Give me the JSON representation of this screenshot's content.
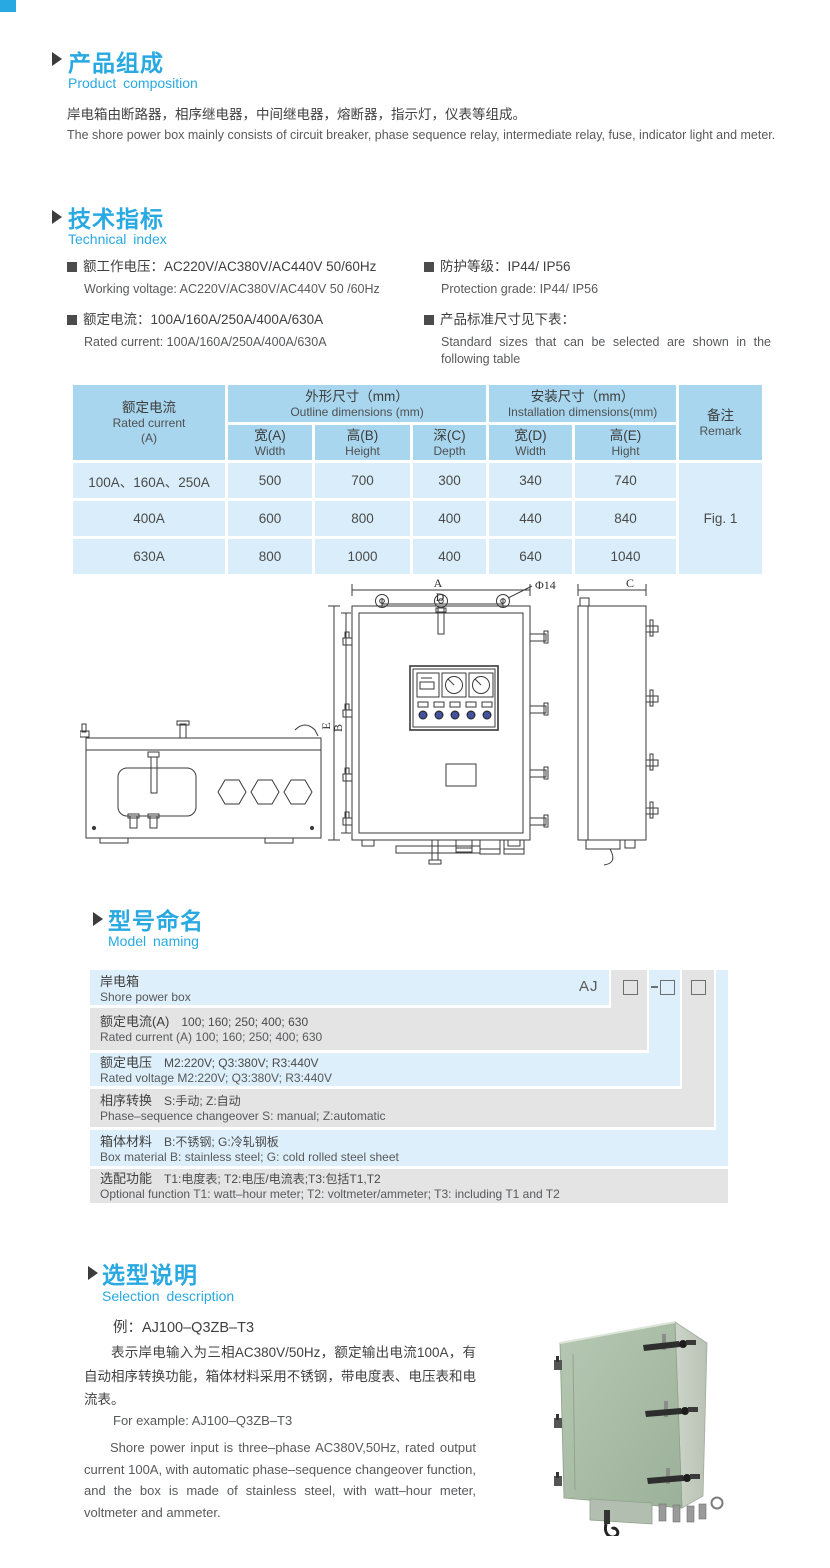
{
  "colors": {
    "accent": "#29a9e1",
    "table_header_bg": "#a8d6ee",
    "table_body_bg": "#d9eefa",
    "ladder_blue": "#ddeffa",
    "ladder_gray": "#e4e4e4",
    "text_dark": "#3f3f3f",
    "text_gray": "#58595b",
    "product_green": "#a9bda6"
  },
  "product_composition": {
    "title_cn": "产品组成",
    "title_en": "Product composition",
    "body_cn": "岸电箱由断路器，相序继电器，中间继电器，熔断器，指示灯，仪表等组成。",
    "body_en": "The shore power box mainly consists of circuit breaker, phase sequence relay, intermediate relay, fuse, indicator light and meter."
  },
  "technical_index": {
    "title_cn": "技术指标",
    "title_en": "Technical index",
    "specs_left": [
      {
        "cn": "额工作电压：AC220V/AC380V/AC440V  50/60Hz",
        "en": "Working voltage: AC220V/AC380V/AC440V 50 /60Hz"
      },
      {
        "cn": "额定电流：100A/160A/250A/400A/630A",
        "en": "Rated current: 100A/160A/250A/400A/630A"
      }
    ],
    "specs_right": [
      {
        "cn": "防护等级：IP44/ IP56",
        "en": "Protection grade: IP44/ IP56"
      },
      {
        "cn": "产品标准尺寸见下表：",
        "en": "Standard sizes that can be selected are shown in the following table"
      }
    ]
  },
  "dimensions_table": {
    "rated_current_header": {
      "cn": "额定电流",
      "en": "Rated current",
      "unit": "(A)"
    },
    "outline_group": {
      "cn": "外形尺寸（mm）",
      "en": "Outline dimensions (mm)"
    },
    "install_group": {
      "cn": "安装尺寸（mm）",
      "en": "Installation dimensions(mm)"
    },
    "remark_header": {
      "cn": "备注",
      "en": "Remark"
    },
    "sub_headers": [
      {
        "cn": "宽(A)",
        "en": "Width"
      },
      {
        "cn": "高(B)",
        "en": "Height"
      },
      {
        "cn": "深(C)",
        "en": "Depth"
      },
      {
        "cn": "宽(D)",
        "en": "Width"
      },
      {
        "cn": "高(E)",
        "en": "Hight"
      }
    ],
    "rows": [
      {
        "current": "100A、160A、250A",
        "w": "500",
        "h": "700",
        "d": "300",
        "iw": "340",
        "ih": "740"
      },
      {
        "current": "400A",
        "w": "600",
        "h": "800",
        "d": "400",
        "iw": "440",
        "ih": "840"
      },
      {
        "current": "630A",
        "w": "800",
        "h": "1000",
        "d": "400",
        "iw": "640",
        "ih": "1040"
      }
    ],
    "remark_value": "Fig. 1"
  },
  "drawing": {
    "dim_a": "A",
    "dim_d": "D",
    "dim_phi": "Φ14",
    "dim_e": "E",
    "dim_b": "B",
    "dim_c": "C"
  },
  "model_naming": {
    "title_cn": "型号命名",
    "title_en": "Model naming",
    "code_prefix": "AJ",
    "rows": [
      {
        "label_cn": "岸电箱",
        "value_cn": "",
        "label_en": "Shore power box",
        "value_en": ""
      },
      {
        "label_cn": "额定电流(A)",
        "value_cn": "100; 160; 250; 400; 630",
        "label_en": "Rated current (A)",
        "value_en": "100; 160; 250; 400; 630"
      },
      {
        "label_cn": "额定电压",
        "value_cn": "M2:220V;  Q3:380V;  R3:440V",
        "label_en": "Rated voltage",
        "value_en": "M2:220V;  Q3:380V;  R3:440V"
      },
      {
        "label_cn": "相序转换",
        "value_cn": "S:手动; Z:自动",
        "label_en": "Phase–sequence changeover",
        "value_en": "S: manual;  Z:automatic"
      },
      {
        "label_cn": "箱体材料",
        "value_cn": "B:不锈钢;  G:冷轧钢板",
        "label_en": "Box material",
        "value_en": "B: stainless steel; G: cold rolled steel sheet"
      },
      {
        "label_cn": "选配功能",
        "value_cn": "T1:电度表;  T2:电压/电流表;T3:包括T1,T2",
        "label_en": "Optional function",
        "value_en": "T1: watt–hour meter; T2: voltmeter/ammeter; T3: including T1 and T2"
      }
    ]
  },
  "selection": {
    "title_cn": "选型说明",
    "title_en": "Selection description",
    "example_cn": "例：AJ100–Q3ZB–T3",
    "body_cn": "表示岸电输入为三相AC380V/50Hz，额定输出电流100A，有自动相序转换功能，箱体材料采用不锈钢，带电度表、电压表和电流表。",
    "example_en": "For example: AJ100–Q3ZB–T3",
    "body_en": "Shore power input is three–phase AC380V,50Hz, rated output current 100A, with automatic phase–sequence changeover function, and the box is made of stainless steel, with watt–hour meter, voltmeter and ammeter."
  }
}
